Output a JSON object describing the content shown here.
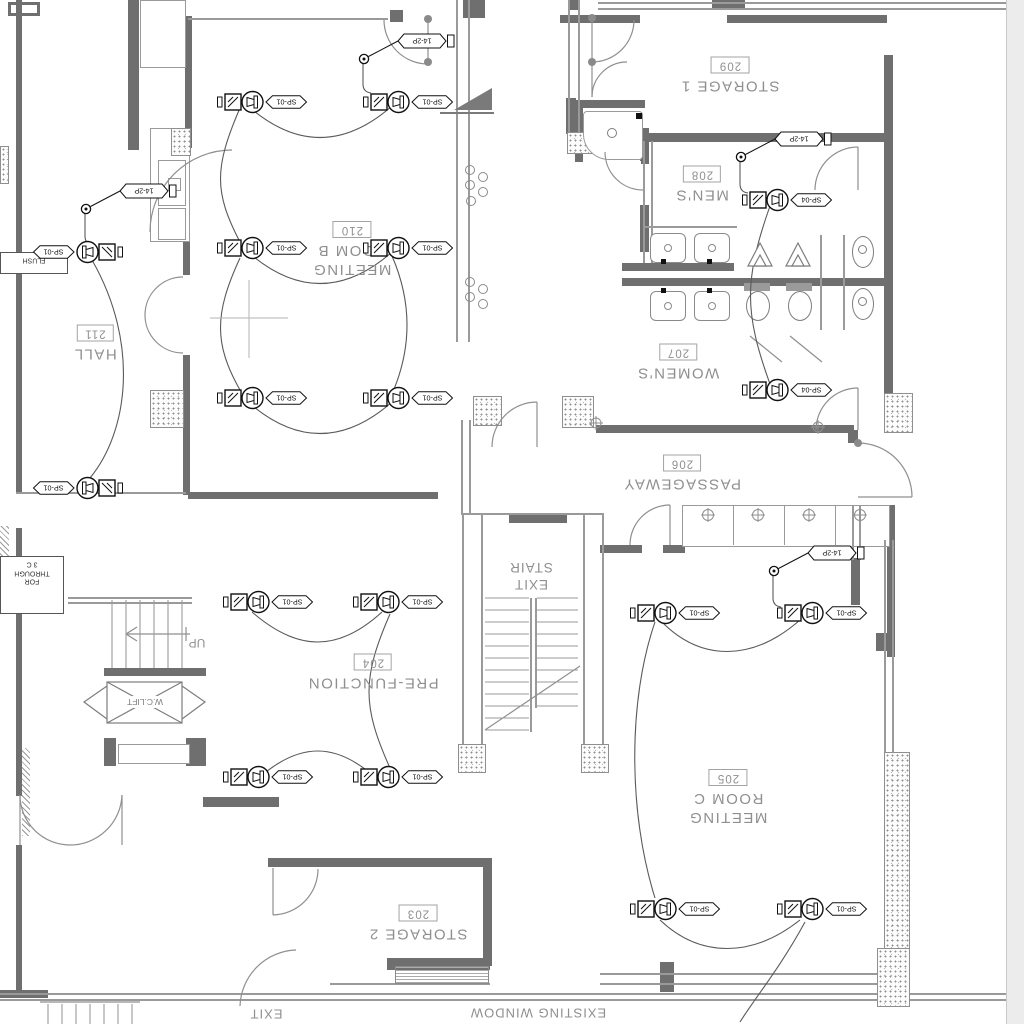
{
  "rooms": [
    {
      "id": "storage-1",
      "name_lines": [
        "STORAGE 1"
      ],
      "number": "209",
      "x": 730,
      "y": 76
    },
    {
      "id": "mens",
      "name_lines": [
        "MEN'S"
      ],
      "number": "208",
      "x": 702,
      "y": 185
    },
    {
      "id": "meeting-room-b",
      "name_lines": [
        "MEETING",
        "ROOM B"
      ],
      "number": "210",
      "x": 352,
      "y": 250
    },
    {
      "id": "hall",
      "name_lines": [
        "HALL"
      ],
      "number": "211",
      "x": 95,
      "y": 344
    },
    {
      "id": "womens",
      "name_lines": [
        "WOMEN'S"
      ],
      "number": "207",
      "x": 678,
      "y": 363
    },
    {
      "id": "passageway",
      "name_lines": [
        "PASSAGEWAY"
      ],
      "number": "206",
      "x": 682,
      "y": 474
    },
    {
      "id": "pre-function",
      "name_lines": [
        "PRE-FUNCTION"
      ],
      "number": "204",
      "x": 373,
      "y": 673
    },
    {
      "id": "meeting-room-c",
      "name_lines": [
        "MEETING",
        "ROOM C"
      ],
      "number": "205",
      "x": 728,
      "y": 798
    },
    {
      "id": "storage-2",
      "name_lines": [
        "STORAGE 2"
      ],
      "number": "203",
      "x": 418,
      "y": 924
    }
  ],
  "stair_label": {
    "lines": [
      "EXIT",
      "STAIR"
    ],
    "x": 531,
    "y": 576
  },
  "annotations": {
    "up": "UP",
    "wc_lift": "W.C.LIFT",
    "exit": "EXIT",
    "existing_window": "EXISTING WINDOW",
    "flush_note": "FLUSH",
    "cable_note_lines": [
      "3 C",
      "THROUGH",
      "FOR"
    ]
  },
  "devices": [
    {
      "x": 216,
      "y": 89,
      "tag": "SP-01",
      "dir": "right",
      "room": "meeting-room-b"
    },
    {
      "x": 362,
      "y": 89,
      "tag": "SP-01",
      "dir": "right",
      "room": "meeting-room-b"
    },
    {
      "x": 216,
      "y": 235,
      "tag": "SP-01",
      "dir": "right",
      "room": "meeting-room-b"
    },
    {
      "x": 362,
      "y": 235,
      "tag": "SP-01",
      "dir": "right",
      "room": "meeting-room-b"
    },
    {
      "x": 216,
      "y": 385,
      "tag": "SP-01",
      "dir": "right",
      "room": "meeting-room-b"
    },
    {
      "x": 362,
      "y": 385,
      "tag": "SP-01",
      "dir": "right",
      "room": "meeting-room-b"
    },
    {
      "x": 32,
      "y": 239,
      "tag": "SP-01",
      "dir": "left",
      "room": "hall"
    },
    {
      "x": 32,
      "y": 475,
      "tag": "SP-01",
      "dir": "left",
      "room": "hall"
    },
    {
      "x": 741,
      "y": 187,
      "tag": "SP-04",
      "dir": "right",
      "room": "mens"
    },
    {
      "x": 741,
      "y": 377,
      "tag": "SP-04",
      "dir": "right",
      "room": "womens"
    },
    {
      "x": 629,
      "y": 600,
      "tag": "SP-01",
      "dir": "right",
      "room": "meeting-room-c"
    },
    {
      "x": 776,
      "y": 600,
      "tag": "SP-01",
      "dir": "right",
      "room": "meeting-room-c"
    },
    {
      "x": 629,
      "y": 896,
      "tag": "SP-01",
      "dir": "right",
      "room": "meeting-room-c"
    },
    {
      "x": 776,
      "y": 896,
      "tag": "SP-01",
      "dir": "right",
      "room": "meeting-room-c"
    },
    {
      "x": 222,
      "y": 589,
      "tag": "SP-01",
      "dir": "right",
      "room": "pre-function"
    },
    {
      "x": 352,
      "y": 589,
      "tag": "SP-01",
      "dir": "right",
      "room": "pre-function"
    },
    {
      "x": 222,
      "y": 764,
      "tag": "SP-01",
      "dir": "right",
      "room": "pre-function"
    },
    {
      "x": 352,
      "y": 764,
      "tag": "SP-01",
      "dir": "right",
      "room": "pre-function"
    }
  ],
  "junctions": [
    {
      "x": 358,
      "y": 28,
      "tag": "14-2P"
    },
    {
      "x": 80,
      "y": 178,
      "tag": "14-2P"
    },
    {
      "x": 735,
      "y": 126,
      "tag": "14-2P"
    },
    {
      "x": 768,
      "y": 540,
      "tag": "14-2P"
    }
  ],
  "colors": {
    "wall": "#6f6f6f",
    "line": "#9a9a9a",
    "device": "#111111",
    "label": "#8f8f8f",
    "page_edge": "#ececec"
  }
}
